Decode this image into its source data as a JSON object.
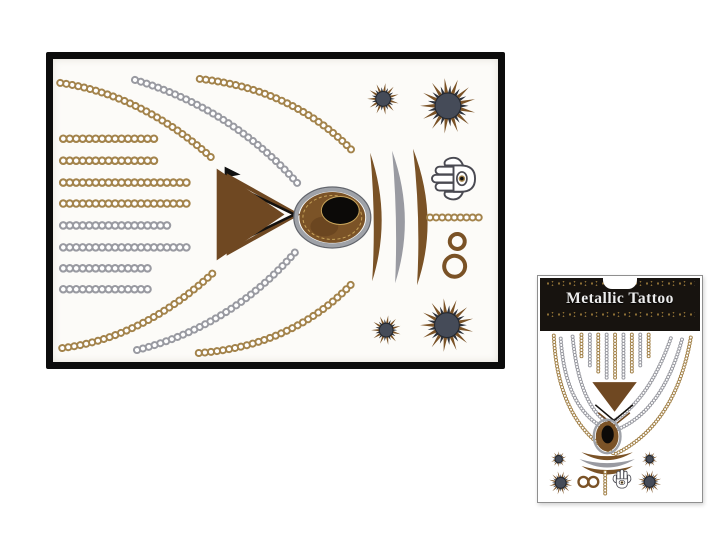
{
  "package": {
    "title": "Metallic Tattoo"
  },
  "icons": [
    "chain-row-icon",
    "necklace-chain-arc-icon",
    "triangle-pendant-icon",
    "oval-gem-icon",
    "crescent-icon",
    "sunburst-icon",
    "hamsa-icon",
    "infinity-icon"
  ],
  "colors": {
    "gold": "#a3834b",
    "silver": "#999aa1",
    "bronze": "#7a5226",
    "brown": "#6f4822",
    "slate": "#454b58",
    "sheet": "#fcfbf8",
    "header": "#17130f",
    "orn": "#8d6f35",
    "title": "#ededed"
  }
}
